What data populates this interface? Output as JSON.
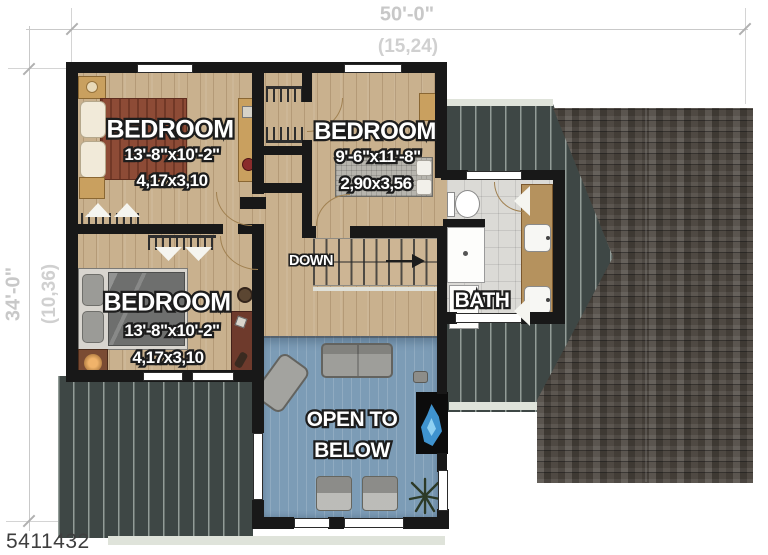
{
  "plan_number": "5411432",
  "dimensions": {
    "top_imperial": "50'-0\"",
    "top_metric": "(15,24)",
    "left_imperial": "34'-0\"",
    "left_metric": "(10,36)"
  },
  "rooms": {
    "bedroom_top_left": {
      "label": "BEDROOM",
      "size_imperial": "13'-8\"x10'-2\"",
      "size_metric": "4,17x3,10"
    },
    "bedroom_top_right": {
      "label": "BEDROOM",
      "size_imperial": "9'-6\"x11'-8\"",
      "size_metric": "2,90x3,56"
    },
    "bedroom_bottom_left": {
      "label": "BEDROOM",
      "size_imperial": "13'-8\"x10'-2\"",
      "size_metric": "4,17x3,10"
    },
    "bath": {
      "label": "BATH"
    },
    "stairs": {
      "label": "DOWN"
    },
    "open_to_below": {
      "line1": "OPEN TO",
      "line2": "BELOW"
    }
  },
  "icons": {
    "closet-rod-icon": "hanger rail with hangers (comb teeth)",
    "bifold-door-icon": "white triangle chevron",
    "door-swing-icon": "quarter-circle arc",
    "stairs-direction-arrow-icon": "right-pointing solid triangle",
    "plant-icon": "radiating leaf starburst",
    "fireplace-flame-icon": "blue flame in black firebox"
  },
  "colors": {
    "wood_floor": "#c9b18e",
    "open_below_floor": "#7c9cb6",
    "wall": "#181818",
    "bath_tile": "#dbdad6",
    "roof_shingle": "#48423b",
    "roof_striped": "#3e4745",
    "bed_blanket_red": "#8d4b36",
    "dimension_text": "#c8c8c8",
    "plan_number_text": "#3e3e3e",
    "label_text": "#ffffff",
    "label_outline": "#1d1d1d"
  }
}
